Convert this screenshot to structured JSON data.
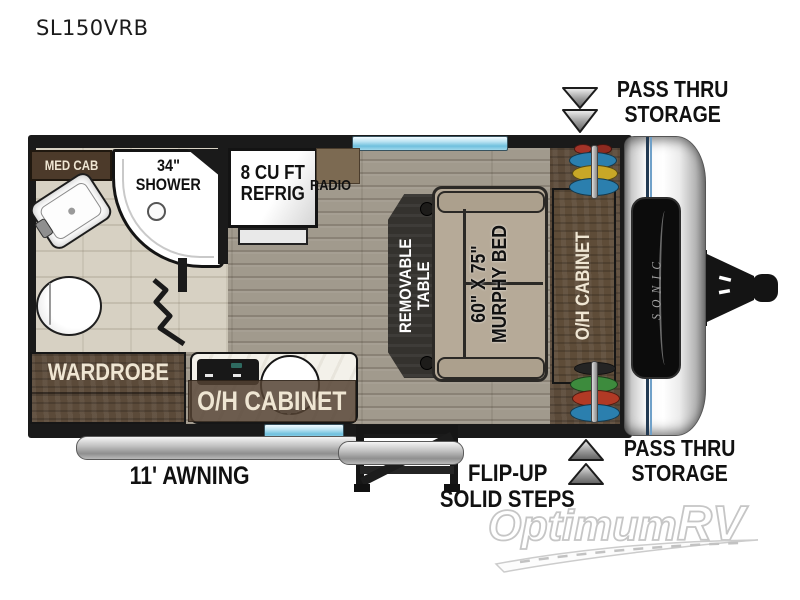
{
  "title": "SL150VRB",
  "floorplan": {
    "med_cab": "MED CAB",
    "shower_line1": "34\"",
    "shower_line2": "SHOWER",
    "refrig_line1": "8 CU FT",
    "refrig_line2": "REFRIG",
    "radio": "RADIO",
    "table_line1": "REMOVABLE",
    "table_line2": "TABLE",
    "bed_line1": "60\" X 75\"",
    "bed_line2": "MURPHY BED",
    "oh_cabinet_front": "O/H CABINET",
    "wardrobe": "WARDROBE",
    "oh_cabinet_kitchen": "O/H CABINET",
    "front_cap_logo": "SONIC"
  },
  "callouts": {
    "pass_thru_top_line1": "PASS THRU",
    "pass_thru_top_line2": "STORAGE",
    "pass_thru_bottom_line1": "PASS THRU",
    "pass_thru_bottom_line2": "STORAGE",
    "awning": "11' AWNING",
    "steps_line1": "FLIP-UP",
    "steps_line2": "SOLID STEPS"
  },
  "watermark": {
    "brand": "Optimum",
    "suffix": "RV"
  },
  "colors": {
    "wall": "#1a1a1a",
    "floor_wood": "#a19a8d",
    "bath_floor": "#d7d1c3",
    "cabinet_brown": "#5b4a39",
    "label_cream": "#efe6d3",
    "window_blue": "#8ecfe8",
    "bed_tan": "#b6aa98",
    "text_black": "#111111"
  }
}
